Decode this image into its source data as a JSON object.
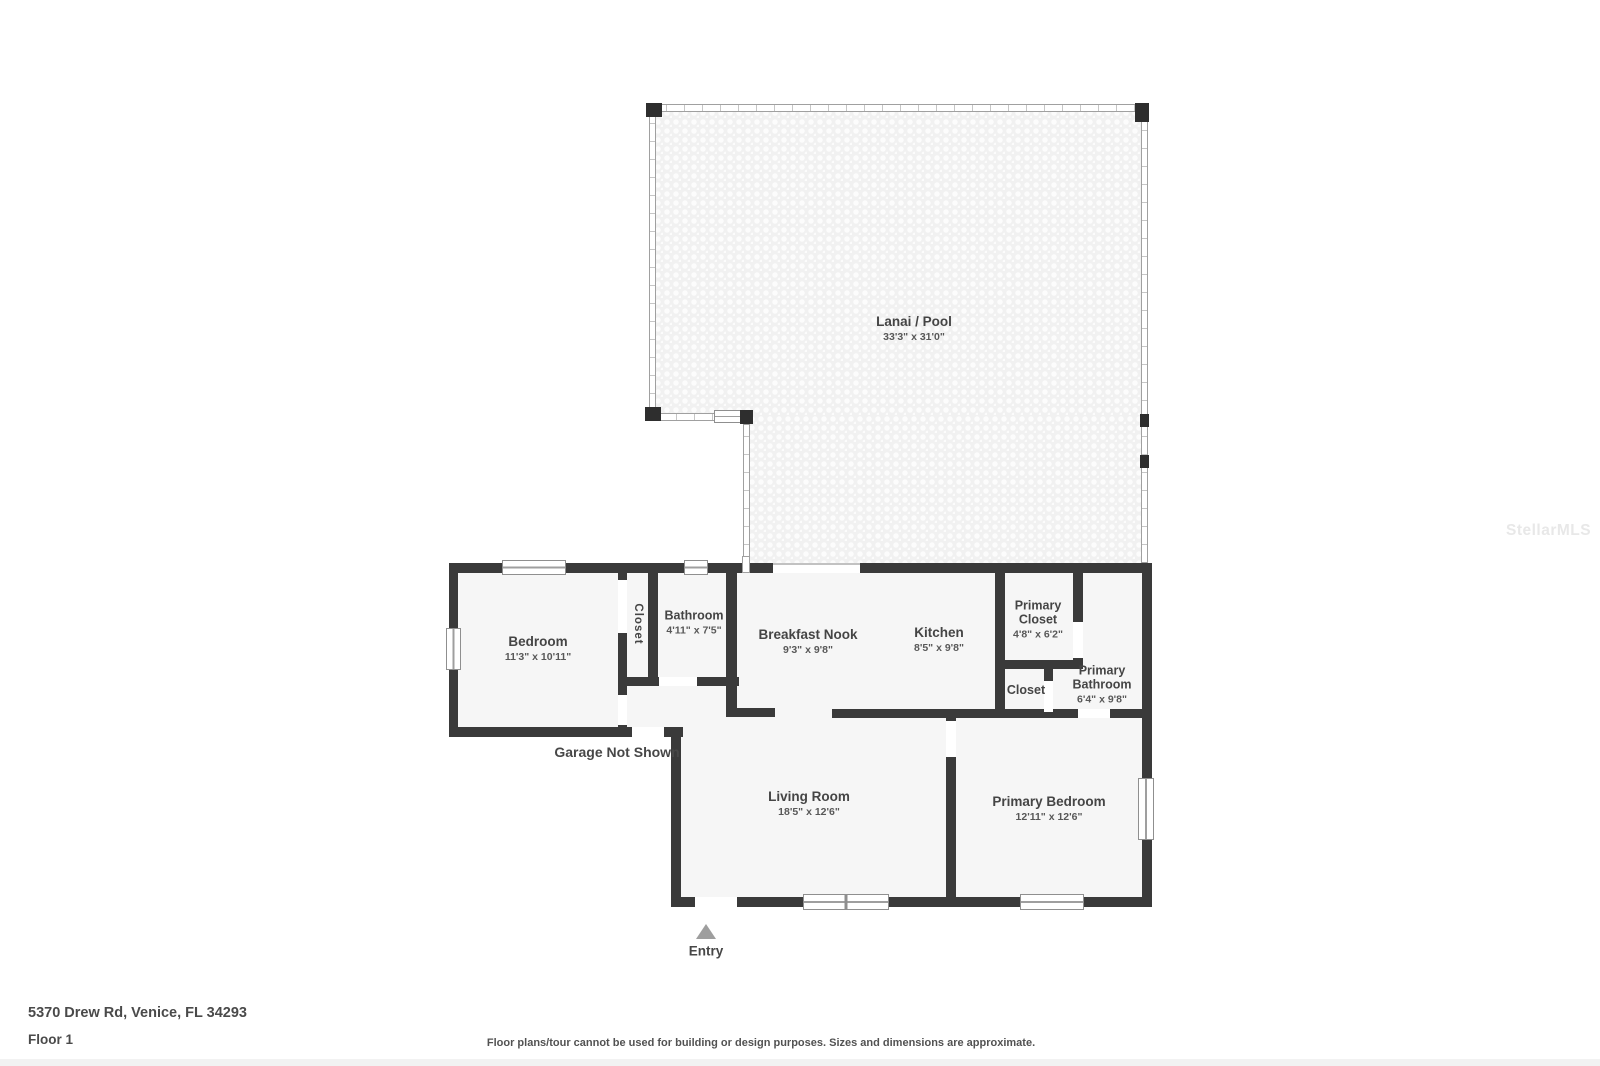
{
  "floorplan": {
    "rooms": [
      {
        "id": "lanai",
        "name": "Lanai / Pool",
        "dims": "33'3\" x 31'0\""
      },
      {
        "id": "bedroom",
        "name": "Bedroom",
        "dims": "11'3\" x 10'11\""
      },
      {
        "id": "closet",
        "name": "Closet",
        "dims": ""
      },
      {
        "id": "bathroom",
        "name": "Bathroom",
        "dims": "4'11\" x 7'5\""
      },
      {
        "id": "breakfast-nook",
        "name": "Breakfast Nook",
        "dims": "9'3\" x 9'8\""
      },
      {
        "id": "kitchen",
        "name": "Kitchen",
        "dims": "8'5\" x 9'8\""
      },
      {
        "id": "primary-closet",
        "name": "Primary Closet",
        "dims": "4'8\" x 6'2\""
      },
      {
        "id": "closet-2",
        "name": "Closet",
        "dims": ""
      },
      {
        "id": "primary-bathroom",
        "name": "Primary Bathroom",
        "dims": "6'4\" x 9'8\""
      },
      {
        "id": "living-room",
        "name": "Living Room",
        "dims": "18'5\" x 12'6\""
      },
      {
        "id": "primary-bedroom",
        "name": "Primary Bedroom",
        "dims": "12'11\" x 12'6\""
      }
    ],
    "annotations": {
      "garage_note": "Garage Not Shown",
      "entry_label": "Entry"
    },
    "footer": {
      "address": "5370 Drew Rd, Venice, FL 34293",
      "floor": "Floor 1",
      "disclaimer": "Floor plans/tour cannot be used for building or design purposes. Sizes and dimensions are approximate."
    },
    "watermark": "StellarMLS",
    "colors": {
      "wall": "#3a3a3a",
      "room_fill": "#f6f6f6",
      "lanai_texture": "#f1f1f1",
      "label_text": "#454545",
      "entry_arrow": "#9e9e9e",
      "watermark_text": "#e8e8e8"
    }
  }
}
